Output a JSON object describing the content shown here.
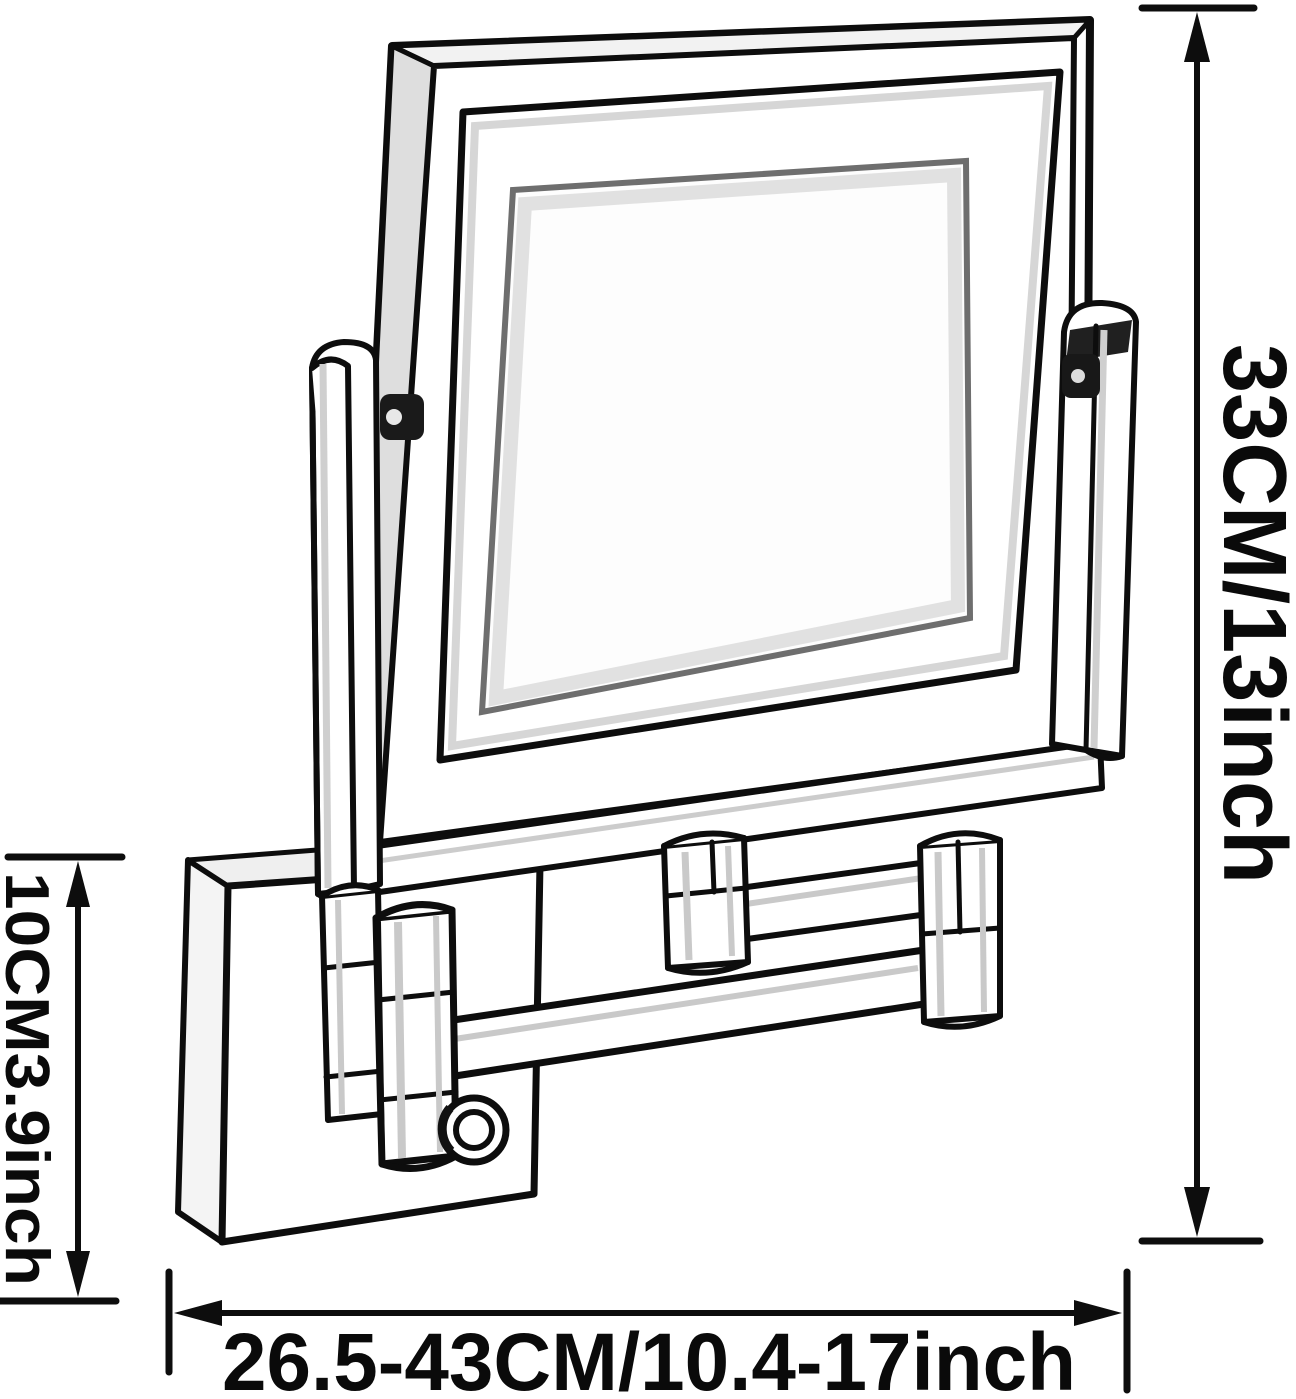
{
  "figure": {
    "description": "Black-and-white line drawing of a wall-mounted extendable folding-arm makeup mirror with dimension arrows",
    "background_color": "#ffffff",
    "ink_color": "#0d0d0d",
    "shade_color": "#dedede"
  },
  "dimensions": {
    "total_height": {
      "label": "33CM/13inch",
      "position": "right",
      "orientation": "vertical"
    },
    "mount_height": {
      "label": "10CM3.9inch",
      "position": "left",
      "orientation": "vertical"
    },
    "extension_range": {
      "label": "26.5-43CM/10.4-17inch",
      "position": "bottom",
      "orientation": "horizontal"
    }
  }
}
